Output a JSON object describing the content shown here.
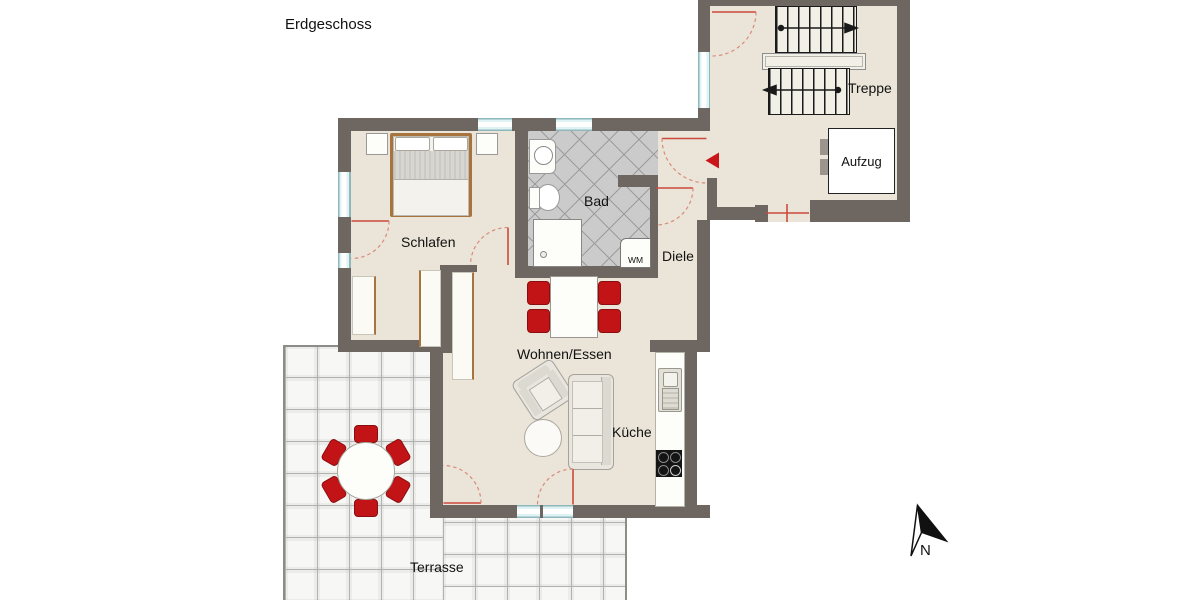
{
  "title": "Erdgeschoss",
  "rooms": {
    "schlafen": "Schlafen",
    "bad": "Bad",
    "diele": "Diele",
    "wohnen_essen": "Wohnen/Essen",
    "kueche": "Küche",
    "terrasse": "Terrasse"
  },
  "stairwell": {
    "treppe": "Treppe",
    "aufzug": "Aufzug"
  },
  "appliances": {
    "wm": "WM"
  },
  "compass": {
    "north": "N"
  },
  "colors": {
    "wall": "#6e6761",
    "floor": "#eae5d8",
    "accent_red": "#c21417",
    "wood": "#a8743e",
    "window": "#dff2f4",
    "bath_tile": "#cbcbcb"
  }
}
